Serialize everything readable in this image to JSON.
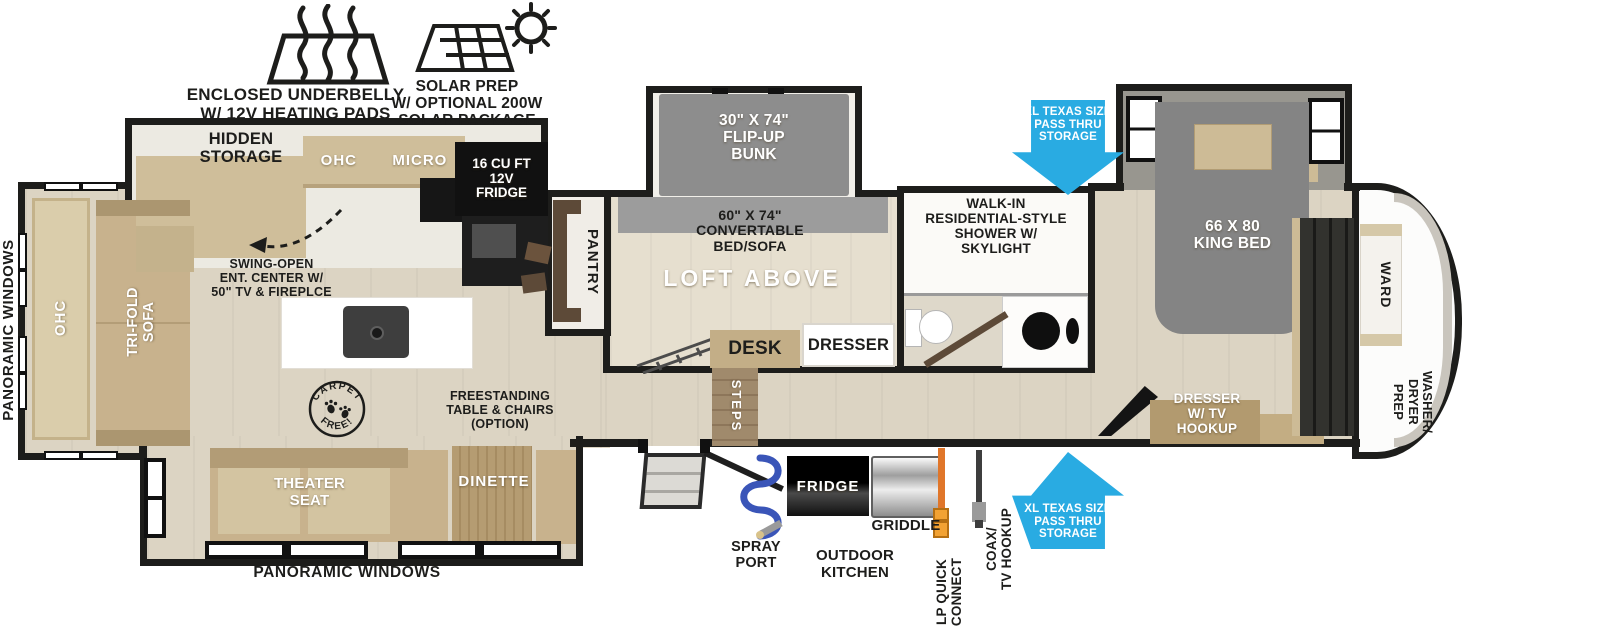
{
  "callouts": {
    "underbelly": "ENCLOSED UNDERBELLY\nW/ 12V HEATING PADS",
    "solar": "SOLAR PREP\nW/ OPTIONAL 200W\nSOLAR PACKAGE",
    "pass_thru_top": "XL TEXAS SIZE\nPASS THRU\nSTORAGE",
    "pass_thru_bottom": "XL TEXAS SIZE\nPASS THRU\nSTORAGE",
    "carpet_top": "CARPET",
    "carpet_bottom": "FREE!",
    "swing_open": "SWING-OPEN\nENT. CENTER W/\n50\" TV & FIREPLCE",
    "freestanding": "FREESTANDING\nTABLE & CHAIRS\n(OPTION)"
  },
  "exterior": {
    "panoramic_left": "PANORAMIC WINDOWS",
    "panoramic_bottom": "PANORAMIC WINDOWS",
    "spray_port": "SPRAY\nPORT",
    "outdoor_kitchen": "OUTDOOR\nKITCHEN",
    "outdoor_fridge": "FRIDGE",
    "griddle": "GRIDDLE",
    "lp_quick_connect": "LP QUICK\nCONNECT",
    "coax_tv_hookup": "COAX/\nTV HOOKUP"
  },
  "living": {
    "hidden_storage": "HIDDEN\nSTORAGE",
    "ohc_cabinet": "OHC",
    "micro": "MICRO",
    "fridge_12v": "16 CU FT\n12V\nFRIDGE",
    "rear_ohc": "OHC",
    "trifold_sofa": "TRI-FOLD\nSOFA",
    "theater_seat": "THEATER\nSEAT",
    "dinette": "DINETTE",
    "pantry": "PANTRY",
    "steps": "STEPS"
  },
  "loft": {
    "flip_up_bunk": "30\" X 74\"\nFLIP-UP\nBUNK",
    "convertible_bed": "60\" X 74\"\nCONVERTABLE\nBED/SOFA",
    "loft_above": "LOFT ABOVE",
    "desk": "DESK",
    "dresser": "DRESSER"
  },
  "bath": {
    "shower": "WALK-IN\nRESIDENTIAL-STYLE\nSHOWER W/\nSKYLIGHT"
  },
  "bedroom": {
    "king_bed": "66 X 80\nKING BED",
    "dresser_tv": "DRESSER\nW/ TV\nHOOKUP",
    "ward": "WARD",
    "washer_dryer": "WASHER/\nDRYER\nPREP"
  },
  "colors": {
    "arrow_blue": "#29abe2",
    "wall_black": "#1d1d1b",
    "floor_tan": "#dcd4c3",
    "furniture_tan": "#c8b28d",
    "bed_gray": "#858585",
    "lp_orange": "#e0762a",
    "hose_blue": "#3a55b8"
  }
}
